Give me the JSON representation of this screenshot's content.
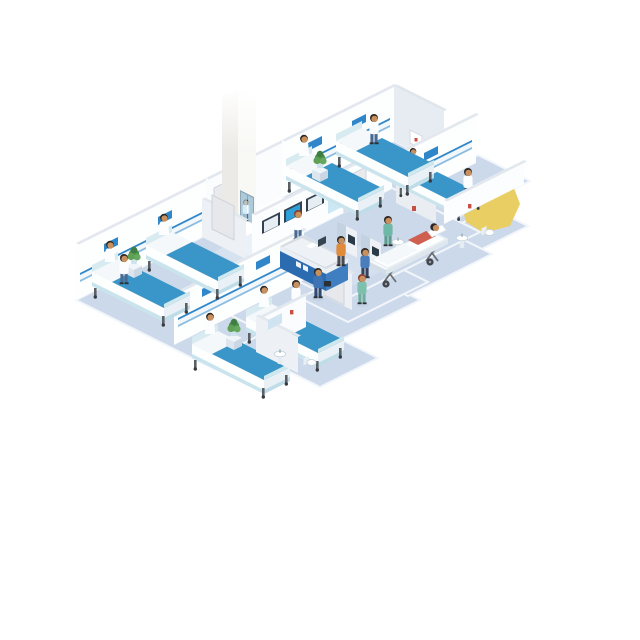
{
  "scene": {
    "type": "isometric-vector-illustration",
    "subject": "hospital ward floor cutaway",
    "description": "Isometric cutaway illustration of a hospital ward floor: four patient rooms with beds and patients, nurses and doctors, a blue reception desk, wall information screens, two self-service kiosks, a glass elevator, a stretcher with a patient, and en-suite bathrooms",
    "background": "#ffffff"
  },
  "palette": {
    "floor": "#ccd9ea",
    "floor_streak": "#dde7f3",
    "floor_rim": "#f2f6fa",
    "wall": "#fdfefe",
    "wall_shaded": "#e9eef3",
    "wall_edge": "#e2e8ee",
    "headboard_stripe": "#2f86c8",
    "blanket_blue": "#3a96c8",
    "mattress_trim": "#c9e4ec",
    "desk_blue": "#2b6cb0",
    "desk_blue_light": "#3f7fc1",
    "screen_blue": "#2e9fd8",
    "screen_frame": "#334150",
    "kiosk_body": "#eef2f6",
    "kiosk_top": "#5b87b8",
    "scrubs_green": "#7fbfae",
    "scrubs_blue": "#3f74b4",
    "coat_white": "#fcfdfe",
    "skin": "#c8905f",
    "hair_dark": "#2c2722",
    "hair_auburn": "#8a4030",
    "plant_green": "#4c8f4c",
    "pot_teal": "#cfe3ee",
    "gurney_patient_top": "#cf5f50",
    "highlight_yellow": "#e9cf63",
    "elevator_glass": "#bfe2f1",
    "metal_gray": "#5a6066"
  },
  "building": {
    "rooms": [
      {
        "id": "room-a",
        "label": "patient room",
        "beds": 2,
        "patients_in_bed": 2,
        "staff": [
          "nurse"
        ],
        "furnishings": [
          "bedside table",
          "potted plant",
          "overbed wall rail",
          "wall signs"
        ]
      },
      {
        "id": "room-b",
        "label": "patient room",
        "beds": 2,
        "patients_in_bed": 2,
        "staff": [
          "nurse"
        ],
        "furnishings": [
          "bedside table",
          "potted plant",
          "overbed wall rail",
          "wall signs"
        ],
        "ensuite": [
          "sink",
          "mirror",
          "toilet"
        ]
      },
      {
        "id": "room-c",
        "label": "patient room",
        "beds": 2,
        "patients_in_bed": 1,
        "staff": [
          "nurse"
        ],
        "furnishings": [
          "bedside table",
          "potted plant",
          "overbed wall rail",
          "wall signs"
        ]
      },
      {
        "id": "room-d",
        "label": "patient room",
        "beds": 1,
        "patients_in_bed": 1,
        "staff": [
          "doctor"
        ],
        "furnishings": [
          "bedside table",
          "potted plant",
          "overbed wall rail",
          "wall sign"
        ],
        "ensuite": [
          "sink",
          "toilet"
        ]
      }
    ],
    "lobby": {
      "reception_desk": {
        "staff": 1,
        "sign_text_legible": false,
        "items": [
          "papers",
          "monitor"
        ]
      },
      "wall_displays": {
        "count": 3,
        "active": "center"
      },
      "glass_panel": true,
      "kiosks": {
        "count": 2,
        "users": 2
      },
      "stretcher": {
        "patients": 1,
        "escort": "nurse"
      },
      "walking_people": [
        "doctor with briefcase",
        "nurse"
      ]
    },
    "elevator": {
      "occupants": 1,
      "door": "glass"
    },
    "bathrooms": 2,
    "effects": [
      {
        "id": "yellow-highlight",
        "shape": "irregular polygon",
        "position": "upper right"
      }
    ]
  },
  "totals": {
    "beds": 7,
    "stretchers": 1,
    "people": 18,
    "plants": 4,
    "doors": 4,
    "screens": 3,
    "kiosks": 2
  }
}
